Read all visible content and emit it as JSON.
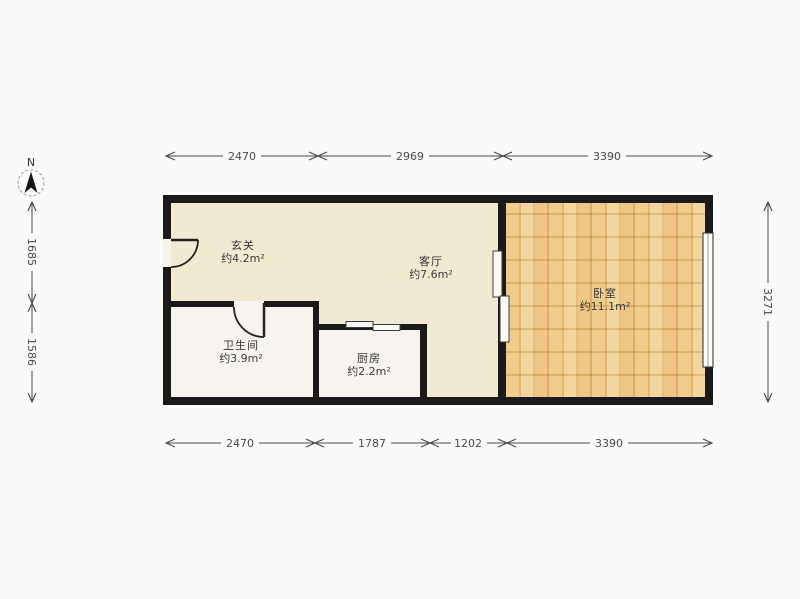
{
  "compass": {
    "label": "N"
  },
  "dimensions": {
    "top": [
      "2470",
      "2969",
      "3390"
    ],
    "bottom": [
      "2470",
      "1787",
      "1202",
      "3390"
    ],
    "left": [
      "1685",
      "1586"
    ],
    "right": [
      "3271"
    ]
  },
  "rooms": {
    "entrance": {
      "name": "玄关",
      "area": "约4.2m²"
    },
    "living": {
      "name": "客厅",
      "area": "约7.6m²"
    },
    "bedroom": {
      "name": "卧室",
      "area": "约11.1m²"
    },
    "bathroom": {
      "name": "卫生间",
      "area": "约3.9m²"
    },
    "kitchen": {
      "name": "厨房",
      "area": "约2.2m²"
    }
  },
  "colors": {
    "wall": "#1b1a18",
    "floor_main": "#f0ead0",
    "floor_wet": "#f6f4ed",
    "wood_light": "#f2d192",
    "wood_dark": "#e2ac5e",
    "dimension": "#4a4a4a",
    "background": "#fafaf9"
  }
}
